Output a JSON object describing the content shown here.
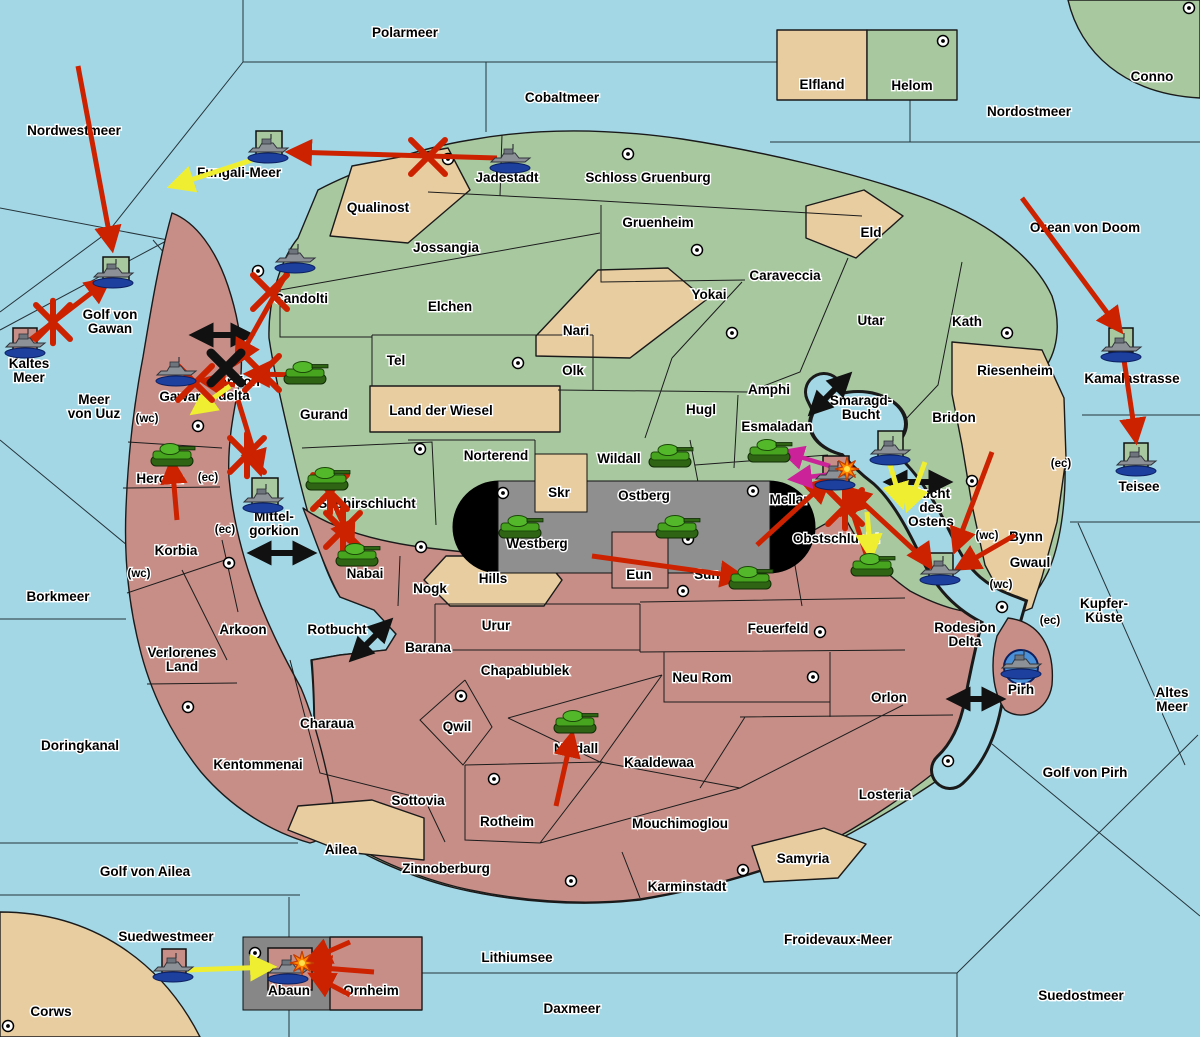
{
  "map": {
    "colors": {
      "sea": "#a3d7e6",
      "land_green": "#a8c8a0",
      "land_tan": "#e8cda0",
      "land_pink": "#c68e87",
      "capsule_grey": "#8f8f8f",
      "box_grey": "#878787",
      "attack_red": "#cc2200",
      "attack_yellow": "#f0ee30",
      "attack_magenta": "#cc2299",
      "move_black": "#111111",
      "pirh_circle_blue": "#4a90d9"
    },
    "sea_labels": [
      {
        "text": "Polarmeer",
        "x": 405,
        "y": 33
      },
      {
        "text": "Nordwestmeer",
        "x": 74,
        "y": 131
      },
      {
        "text": "Cobaltmeer",
        "x": 562,
        "y": 98
      },
      {
        "text": "Nordostmeer",
        "x": 1029,
        "y": 112
      },
      {
        "text": "Ozean von Doom",
        "x": 1085,
        "y": 228
      },
      {
        "text": "Fungali-Meer",
        "x": 239,
        "y": 173
      },
      {
        "lines": [
          "Golf von",
          "Gawan"
        ],
        "x": 110,
        "y": 322
      },
      {
        "lines": [
          "Kaltes",
          "Meer"
        ],
        "x": 29,
        "y": 371
      },
      {
        "lines": [
          "Meer",
          "von Uuz"
        ],
        "x": 94,
        "y": 407
      },
      {
        "text": "Borkmeer",
        "x": 58,
        "y": 597
      },
      {
        "text": "Doringkanal",
        "x": 80,
        "y": 746
      },
      {
        "text": "Golf von Ailea",
        "x": 145,
        "y": 872
      },
      {
        "text": "Suedwestmeer",
        "x": 166,
        "y": 937
      },
      {
        "text": "Lithiumsee",
        "x": 517,
        "y": 958
      },
      {
        "text": "Daxmeer",
        "x": 572,
        "y": 1009
      },
      {
        "text": "Froidevaux-Meer",
        "x": 838,
        "y": 940
      },
      {
        "text": "Suedostmeer",
        "x": 1081,
        "y": 996
      },
      {
        "text": "Golf von Pirh",
        "x": 1085,
        "y": 773
      },
      {
        "lines": [
          "Altes",
          "Meer"
        ],
        "x": 1172,
        "y": 700
      },
      {
        "lines": [
          "Kupfer-",
          "Küste"
        ],
        "x": 1104,
        "y": 611
      },
      {
        "text": "Kamalastrasse",
        "x": 1132,
        "y": 379
      },
      {
        "text": "Teisee",
        "x": 1139,
        "y": 487
      },
      {
        "lines": [
          "Smaragd-",
          "Bucht"
        ],
        "x": 861,
        "y": 408
      },
      {
        "lines": [
          "Bucht",
          "des",
          "Ostens"
        ],
        "x": 931,
        "y": 508
      },
      {
        "lines": [
          "Mittel-",
          "gorkion"
        ],
        "x": 274,
        "y": 524
      },
      {
        "text": "Rotbucht",
        "x": 337,
        "y": 630
      },
      {
        "lines": [
          "Gorkion",
          "delta"
        ],
        "x": 234,
        "y": 389
      },
      {
        "lines": [
          "Rodesion",
          "Delta"
        ],
        "x": 965,
        "y": 635
      }
    ],
    "territory_labels": [
      {
        "text": "Jadestadt",
        "x": 507,
        "y": 178
      },
      {
        "text": "Schloss Gruenburg",
        "x": 648,
        "y": 178
      },
      {
        "text": "Qualinost",
        "x": 378,
        "y": 208
      },
      {
        "text": "Jossangia",
        "x": 446,
        "y": 248
      },
      {
        "text": "Gruenheim",
        "x": 658,
        "y": 223
      },
      {
        "text": "Elchen",
        "x": 450,
        "y": 307
      },
      {
        "text": "Eld",
        "x": 871,
        "y": 233
      },
      {
        "text": "Caraveccia",
        "x": 785,
        "y": 276
      },
      {
        "text": "Yokai",
        "x": 709,
        "y": 295
      },
      {
        "text": "Tel",
        "x": 396,
        "y": 361
      },
      {
        "text": "Nari",
        "x": 576,
        "y": 331
      },
      {
        "text": "Olk",
        "x": 573,
        "y": 371
      },
      {
        "text": "Utar",
        "x": 871,
        "y": 321
      },
      {
        "text": "Kath",
        "x": 967,
        "y": 322
      },
      {
        "text": "Land der Wiesel",
        "x": 441,
        "y": 411
      },
      {
        "text": "Riesenheim",
        "x": 1015,
        "y": 371
      },
      {
        "text": "Bridon",
        "x": 954,
        "y": 418
      },
      {
        "text": "Amphi",
        "x": 769,
        "y": 390
      },
      {
        "text": "Hugl",
        "x": 701,
        "y": 410
      },
      {
        "text": "Esmaladan",
        "x": 777,
        "y": 427
      },
      {
        "text": "Candolti",
        "x": 301,
        "y": 299
      },
      {
        "text": "Gurand",
        "x": 324,
        "y": 415
      },
      {
        "text": "Gawar",
        "x": 180,
        "y": 397
      },
      {
        "text": "Norterend",
        "x": 496,
        "y": 456
      },
      {
        "text": "Wildall",
        "x": 619,
        "y": 459
      },
      {
        "text": "Skr",
        "x": 559,
        "y": 493
      },
      {
        "text": "Ostberg",
        "x": 644,
        "y": 496
      },
      {
        "text": "Westberg",
        "x": 537,
        "y": 544
      },
      {
        "text": "Mellar",
        "x": 789,
        "y": 500
      },
      {
        "text": "Saphirschlucht",
        "x": 367,
        "y": 504
      },
      {
        "text": "Heronn",
        "x": 160,
        "y": 479
      },
      {
        "text": "Korbia",
        "x": 176,
        "y": 551
      },
      {
        "text": "Nabai",
        "x": 365,
        "y": 574
      },
      {
        "text": "Nogk",
        "x": 430,
        "y": 589
      },
      {
        "text": "Hills",
        "x": 493,
        "y": 579
      },
      {
        "text": "Eun",
        "x": 639,
        "y": 575
      },
      {
        "text": "Sund",
        "x": 711,
        "y": 575
      },
      {
        "text": "Obstschlucht",
        "x": 836,
        "y": 539
      },
      {
        "text": "Arkoon",
        "x": 243,
        "y": 630
      },
      {
        "text": "Barana",
        "x": 428,
        "y": 648
      },
      {
        "text": "Urur",
        "x": 496,
        "y": 626
      },
      {
        "text": "Feuerfeld",
        "x": 778,
        "y": 629
      },
      {
        "lines": [
          "Verlorenes",
          "Land"
        ],
        "x": 182,
        "y": 660
      },
      {
        "text": "Chapablublek",
        "x": 525,
        "y": 671
      },
      {
        "text": "Neu Rom",
        "x": 702,
        "y": 678
      },
      {
        "text": "Qwil",
        "x": 457,
        "y": 727
      },
      {
        "text": "Nilldall",
        "x": 576,
        "y": 749
      },
      {
        "text": "Kaaldewaa",
        "x": 659,
        "y": 763
      },
      {
        "text": "Rotheim",
        "x": 507,
        "y": 822
      },
      {
        "text": "Sottovia",
        "x": 418,
        "y": 801
      },
      {
        "text": "Mouchimoglou",
        "x": 680,
        "y": 824
      },
      {
        "text": "Zinnoberburg",
        "x": 446,
        "y": 869
      },
      {
        "text": "Karminstadt",
        "x": 687,
        "y": 887
      },
      {
        "text": "Kentommenai",
        "x": 258,
        "y": 765
      },
      {
        "text": "Charaua",
        "x": 327,
        "y": 724
      },
      {
        "text": "Ailea",
        "x": 341,
        "y": 850
      },
      {
        "text": "Samyria",
        "x": 803,
        "y": 859
      },
      {
        "text": "Losteria",
        "x": 885,
        "y": 795
      },
      {
        "text": "Orlon",
        "x": 889,
        "y": 698
      },
      {
        "text": "Bynn",
        "x": 1026,
        "y": 537
      },
      {
        "text": "Gwaul",
        "x": 1030,
        "y": 563
      },
      {
        "text": "Pirh",
        "x": 1021,
        "y": 690
      },
      {
        "text": "Elfland",
        "x": 822,
        "y": 85
      },
      {
        "text": "Helom",
        "x": 912,
        "y": 86
      },
      {
        "text": "Conno",
        "x": 1152,
        "y": 77
      },
      {
        "text": "Corws",
        "x": 51,
        "y": 1012
      },
      {
        "text": "Abaun",
        "x": 289,
        "y": 991
      },
      {
        "text": "Ornheim",
        "x": 371,
        "y": 991
      }
    ],
    "small_labels": [
      {
        "text": "(wc)",
        "x": 147,
        "y": 419
      },
      {
        "text": "(ec)",
        "x": 208,
        "y": 478
      },
      {
        "text": "(ec)",
        "x": 225,
        "y": 530
      },
      {
        "text": "(wc)",
        "x": 139,
        "y": 574
      },
      {
        "text": "(ec)",
        "x": 1061,
        "y": 464
      },
      {
        "text": "(wc)",
        "x": 987,
        "y": 536
      },
      {
        "text": "(wc)",
        "x": 1001,
        "y": 585
      },
      {
        "text": "(ec)",
        "x": 1050,
        "y": 621
      }
    ],
    "supply_dots": [
      [
        448,
        159
      ],
      [
        628,
        154
      ],
      [
        943,
        41
      ],
      [
        1189,
        8
      ],
      [
        258,
        271
      ],
      [
        697,
        250
      ],
      [
        732,
        333
      ],
      [
        1007,
        333
      ],
      [
        518,
        363
      ],
      [
        198,
        426
      ],
      [
        420,
        449
      ],
      [
        229,
        563
      ],
      [
        421,
        547
      ],
      [
        503,
        493
      ],
      [
        688,
        539
      ],
      [
        753,
        491
      ],
      [
        683,
        591
      ],
      [
        972,
        481
      ],
      [
        188,
        707
      ],
      [
        461,
        696
      ],
      [
        494,
        779
      ],
      [
        571,
        881
      ],
      [
        743,
        870
      ],
      [
        813,
        677
      ],
      [
        820,
        632
      ],
      [
        948,
        761
      ],
      [
        1002,
        607
      ],
      [
        8,
        1026
      ],
      [
        255,
        953
      ]
    ],
    "unit_bases": [
      {
        "shape": "square",
        "color": "green",
        "x": 256,
        "y": 131,
        "w": 26,
        "h": 26
      },
      {
        "shape": "square",
        "color": "green",
        "x": 103,
        "y": 257,
        "w": 26,
        "h": 25
      },
      {
        "shape": "square",
        "color": "green",
        "x": 252,
        "y": 478,
        "w": 26,
        "h": 30
      },
      {
        "shape": "square",
        "color": "green",
        "x": 878,
        "y": 431,
        "w": 25,
        "h": 26
      },
      {
        "shape": "square",
        "color": "green",
        "x": 929,
        "y": 553,
        "w": 24,
        "h": 24
      },
      {
        "shape": "square",
        "color": "green",
        "x": 1109,
        "y": 328,
        "w": 24,
        "h": 24
      },
      {
        "shape": "square",
        "color": "green",
        "x": 1124,
        "y": 443,
        "w": 24,
        "h": 24
      },
      {
        "shape": "square",
        "color": "pink",
        "x": 13,
        "y": 328,
        "w": 24,
        "h": 23
      },
      {
        "shape": "square",
        "color": "pink",
        "x": 823,
        "y": 456,
        "w": 26,
        "h": 28
      },
      {
        "shape": "square",
        "color": "pink",
        "x": 162,
        "y": 949,
        "w": 24,
        "h": 24
      },
      {
        "shape": "square",
        "color": "pink",
        "x": 268,
        "y": 948,
        "w": 44,
        "h": 42
      },
      {
        "shape": "circle",
        "color": "blue",
        "x": 1021,
        "y": 667,
        "r": 17
      }
    ],
    "units": {
      "tanks": [
        [
          172,
          455
        ],
        [
          305,
          373
        ],
        [
          327,
          479
        ],
        [
          357,
          555
        ],
        [
          670,
          456
        ],
        [
          520,
          527
        ],
        [
          677,
          527
        ],
        [
          769,
          451
        ],
        [
          872,
          565
        ],
        [
          750,
          578
        ],
        [
          575,
          722
        ]
      ],
      "ships": [
        [
          268,
          150
        ],
        [
          510,
          160
        ],
        [
          113,
          275
        ],
        [
          25,
          345
        ],
        [
          295,
          260
        ],
        [
          176,
          373
        ],
        [
          263,
          500
        ],
        [
          890,
          452
        ],
        [
          835,
          477
        ],
        [
          940,
          572
        ],
        [
          1121,
          349
        ],
        [
          1136,
          463
        ],
        [
          1021,
          666
        ],
        [
          173,
          969
        ],
        [
          288,
          971
        ]
      ]
    },
    "attack_arrows": [
      {
        "color": "red",
        "x1": 78,
        "y1": 66,
        "x2": 112,
        "y2": 248
      },
      {
        "color": "red",
        "x1": 497,
        "y1": 158,
        "x2": 290,
        "y2": 152
      },
      {
        "color": "red",
        "x1": 30,
        "y1": 340,
        "x2": 108,
        "y2": 280
      },
      {
        "color": "red",
        "x1": 293,
        "y1": 262,
        "x2": 237,
        "y2": 362
      },
      {
        "color": "red",
        "x1": 310,
        "y1": 375,
        "x2": 248,
        "y2": 374
      },
      {
        "color": "red",
        "x1": 235,
        "y1": 385,
        "x2": 203,
        "y2": 381
      },
      {
        "color": "red",
        "x1": 238,
        "y1": 400,
        "x2": 260,
        "y2": 472
      },
      {
        "color": "red",
        "x1": 177,
        "y1": 520,
        "x2": 172,
        "y2": 462
      },
      {
        "color": "red",
        "x1": 330,
        "y1": 495,
        "x2": 352,
        "y2": 543
      },
      {
        "color": "red",
        "x1": 556,
        "y1": 806,
        "x2": 572,
        "y2": 735
      },
      {
        "color": "red",
        "x1": 592,
        "y1": 556,
        "x2": 742,
        "y2": 577
      },
      {
        "color": "red",
        "x1": 868,
        "y1": 560,
        "x2": 846,
        "y2": 492
      },
      {
        "color": "red",
        "x1": 757,
        "y1": 545,
        "x2": 828,
        "y2": 480
      },
      {
        "color": "red",
        "x1": 928,
        "y1": 563,
        "x2": 848,
        "y2": 489
      },
      {
        "color": "red",
        "x1": 992,
        "y1": 452,
        "x2": 955,
        "y2": 550
      },
      {
        "color": "red",
        "x1": 1015,
        "y1": 535,
        "x2": 958,
        "y2": 568
      },
      {
        "color": "red",
        "x1": 918,
        "y1": 548,
        "x2": 930,
        "y2": 566
      },
      {
        "color": "red",
        "x1": 1022,
        "y1": 198,
        "x2": 1120,
        "y2": 330
      },
      {
        "color": "red",
        "x1": 1124,
        "y1": 360,
        "x2": 1136,
        "y2": 440
      },
      {
        "color": "red",
        "x1": 374,
        "y1": 972,
        "x2": 310,
        "y2": 967
      },
      {
        "color": "red",
        "x1": 350,
        "y1": 942,
        "x2": 309,
        "y2": 960
      },
      {
        "color": "red",
        "x1": 350,
        "y1": 995,
        "x2": 312,
        "y2": 975
      },
      {
        "color": "yellow",
        "x1": 252,
        "y1": 160,
        "x2": 172,
        "y2": 186
      },
      {
        "color": "yellow",
        "x1": 188,
        "y1": 970,
        "x2": 272,
        "y2": 967
      },
      {
        "color": "yellow",
        "x1": 230,
        "y1": 386,
        "x2": 194,
        "y2": 412
      },
      {
        "color": "yellow",
        "x1": 888,
        "y1": 458,
        "x2": 902,
        "y2": 505
      },
      {
        "color": "yellow",
        "x1": 925,
        "y1": 462,
        "x2": 908,
        "y2": 508
      },
      {
        "color": "yellow",
        "x1": 867,
        "y1": 512,
        "x2": 871,
        "y2": 556
      },
      {
        "color": "magenta",
        "x1": 830,
        "y1": 466,
        "x2": 784,
        "y2": 452
      },
      {
        "color": "magenta",
        "x1": 833,
        "y1": 474,
        "x2": 792,
        "y2": 479
      }
    ],
    "movement_arrows": [
      {
        "x": 222,
        "y": 335,
        "angle": 0,
        "len": 52
      },
      {
        "x": 282,
        "y": 553,
        "angle": 0,
        "len": 56
      },
      {
        "x": 371,
        "y": 640,
        "angle": -45,
        "len": 48
      },
      {
        "x": 830,
        "y": 394,
        "angle": -45,
        "len": 48
      },
      {
        "x": 918,
        "y": 482,
        "angle": 0,
        "len": 56
      },
      {
        "x": 976,
        "y": 699,
        "angle": 0,
        "len": 46
      }
    ],
    "x_marks": [
      {
        "x": 53,
        "y": 322,
        "color": "red",
        "arms": 3
      },
      {
        "x": 428,
        "y": 157,
        "color": "red",
        "arms": 2
      },
      {
        "x": 270,
        "y": 292,
        "color": "red",
        "arms": 2
      },
      {
        "x": 262,
        "y": 373,
        "color": "red",
        "arms": 2
      },
      {
        "x": 195,
        "y": 383,
        "color": "red",
        "arms": 2
      },
      {
        "x": 247,
        "y": 455,
        "color": "red",
        "arms": 3
      },
      {
        "x": 330,
        "y": 492,
        "color": "red",
        "arms": 3
      },
      {
        "x": 343,
        "y": 530,
        "color": "red",
        "arms": 3
      },
      {
        "x": 845,
        "y": 507,
        "color": "red",
        "arms": 3
      },
      {
        "x": 226,
        "y": 368,
        "color": "black",
        "arms": 2
      }
    ],
    "explosions": [
      [
        847,
        469
      ],
      [
        302,
        963
      ]
    ]
  }
}
